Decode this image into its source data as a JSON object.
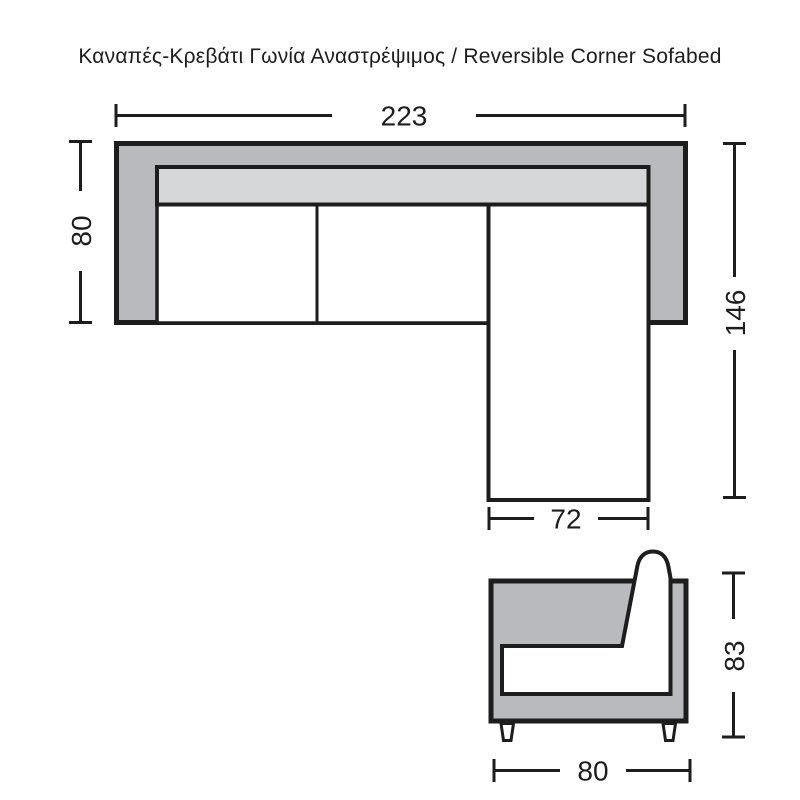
{
  "title": "Καναπές-Κρεβάτι Γωνία Αναστρέψιμος / Reversible Corner Sofabed",
  "top_view": {
    "dim_width_total": "223",
    "dim_depth_left": "80",
    "dim_depth_right": "146",
    "dim_chaise_width": "72"
  },
  "side_view": {
    "dim_height": "83",
    "dim_depth": "80"
  },
  "colors": {
    "frame_gray": "#b9babe",
    "cushion_gray": "#d6d7d9",
    "seat_white": "#ffffff",
    "line": "#1d1d1d"
  }
}
